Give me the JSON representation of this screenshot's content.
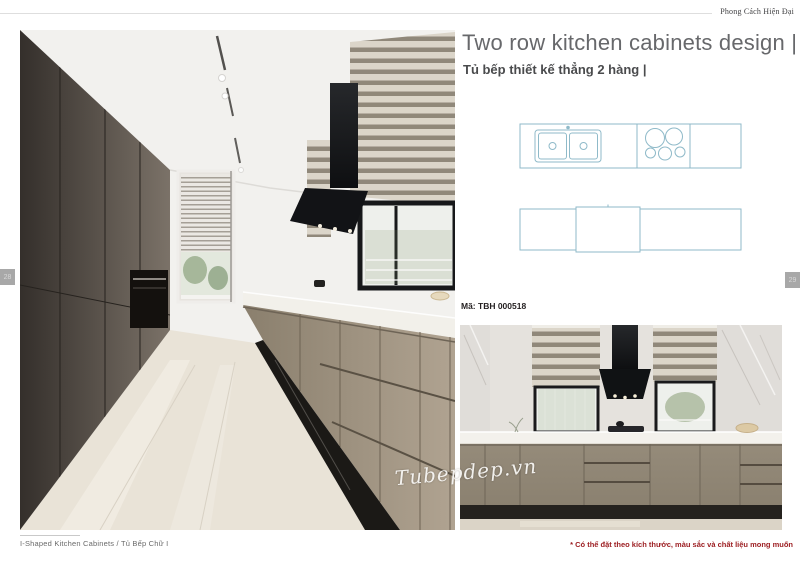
{
  "page": {
    "category_label": "Phong Cách Hiện Đại",
    "page_number_left": "28",
    "page_number_right": "29"
  },
  "hero": {
    "title_en": "Two row kitchen cabinets design |",
    "title_vi": "Tủ bếp thiết kế thẳng 2 hàng |"
  },
  "product": {
    "code": "Mã: TBH 000518"
  },
  "watermark": {
    "text": "Tubepdep.vn"
  },
  "footer": {
    "section_label": "I-Shaped Kitchen Cabinets / Tủ Bếp Chữ I",
    "note": "* Có thể đặt theo kích thước, màu sắc và chất liệu mong muốn"
  },
  "colors": {
    "blueprint_blue": "#8fbac9",
    "note_red": "#9d1f23",
    "tab_gray": "#a8a8a8",
    "title_gray": "#67686b"
  }
}
